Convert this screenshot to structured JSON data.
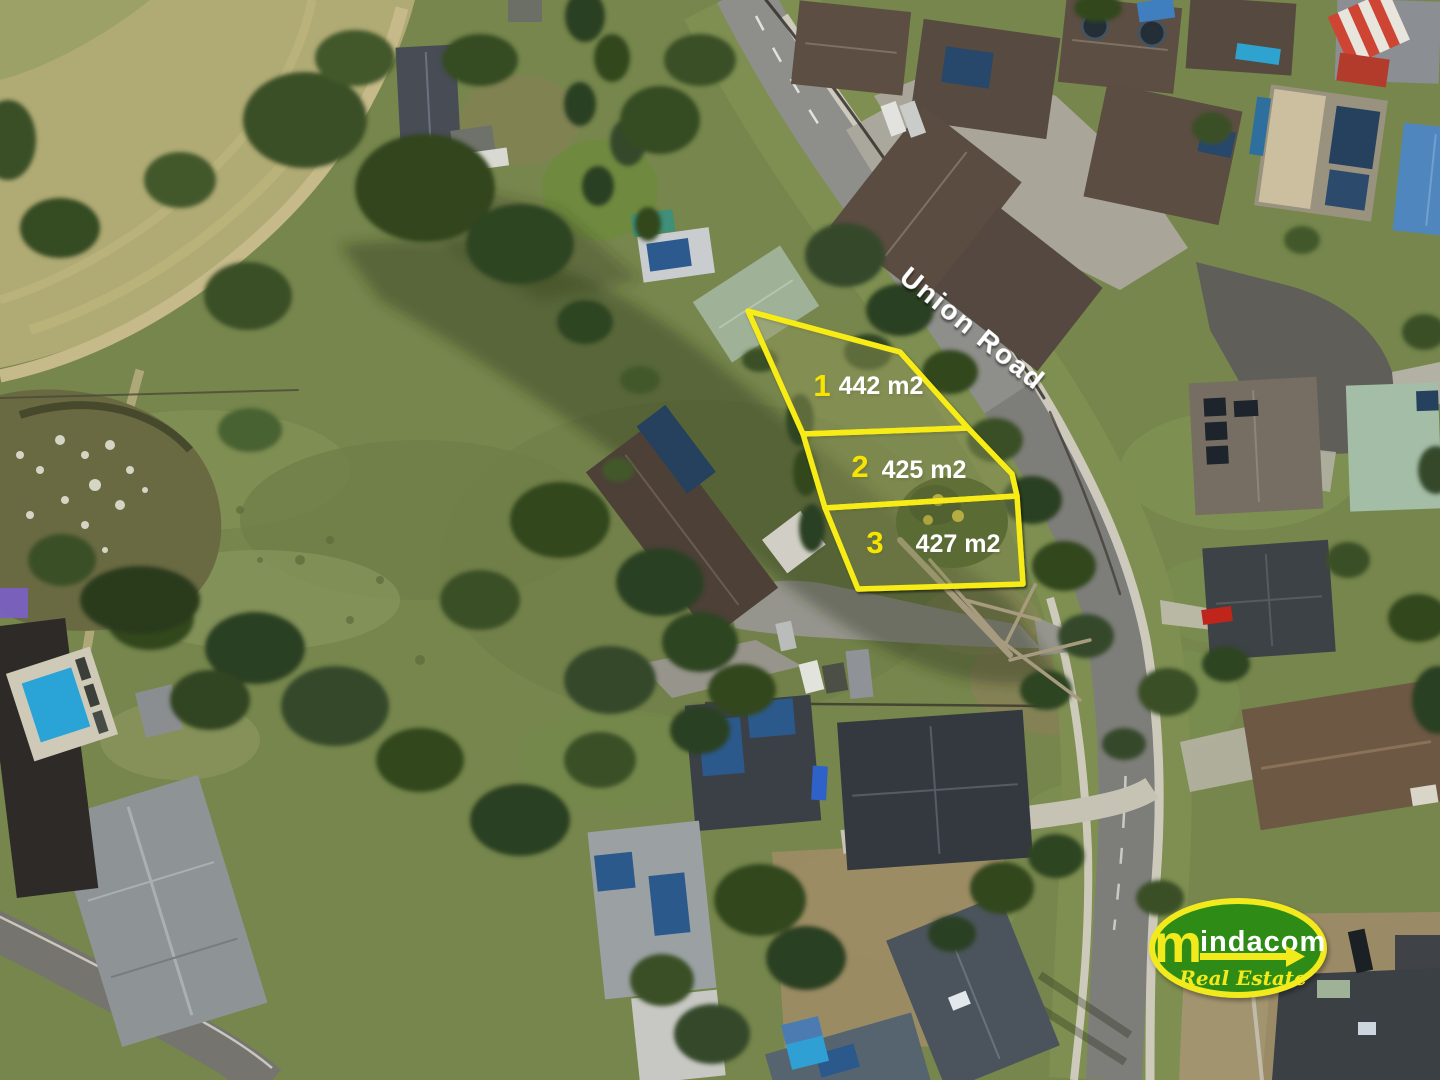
{
  "scene": {
    "description": "Aerial drone photograph of a three-lot residential land subdivision beside Union Road: vacant grass lots outlined in yellow, a suburban housing estate to the north-east, paddocks, a lily pond and swimming pools to the west, and a real estate agency logo at bottom right"
  },
  "road": {
    "name": "Union Road"
  },
  "lots": [
    {
      "number": "1",
      "area": "442 m2"
    },
    {
      "number": "2",
      "area": "425 m2"
    },
    {
      "number": "3",
      "area": "427 m2"
    }
  ],
  "logo": {
    "initial": "m",
    "rest": "indacom",
    "tagline": "Real Estate"
  },
  "colors": {
    "lot_outline": "#f7ec13",
    "lot_number": "#f7e400",
    "area_text": "#ffffff",
    "road_label": "#ffffff",
    "logo_green": "#2f8c17",
    "logo_yellow": "#f2ea1a",
    "logo_text": "#ffffff"
  }
}
